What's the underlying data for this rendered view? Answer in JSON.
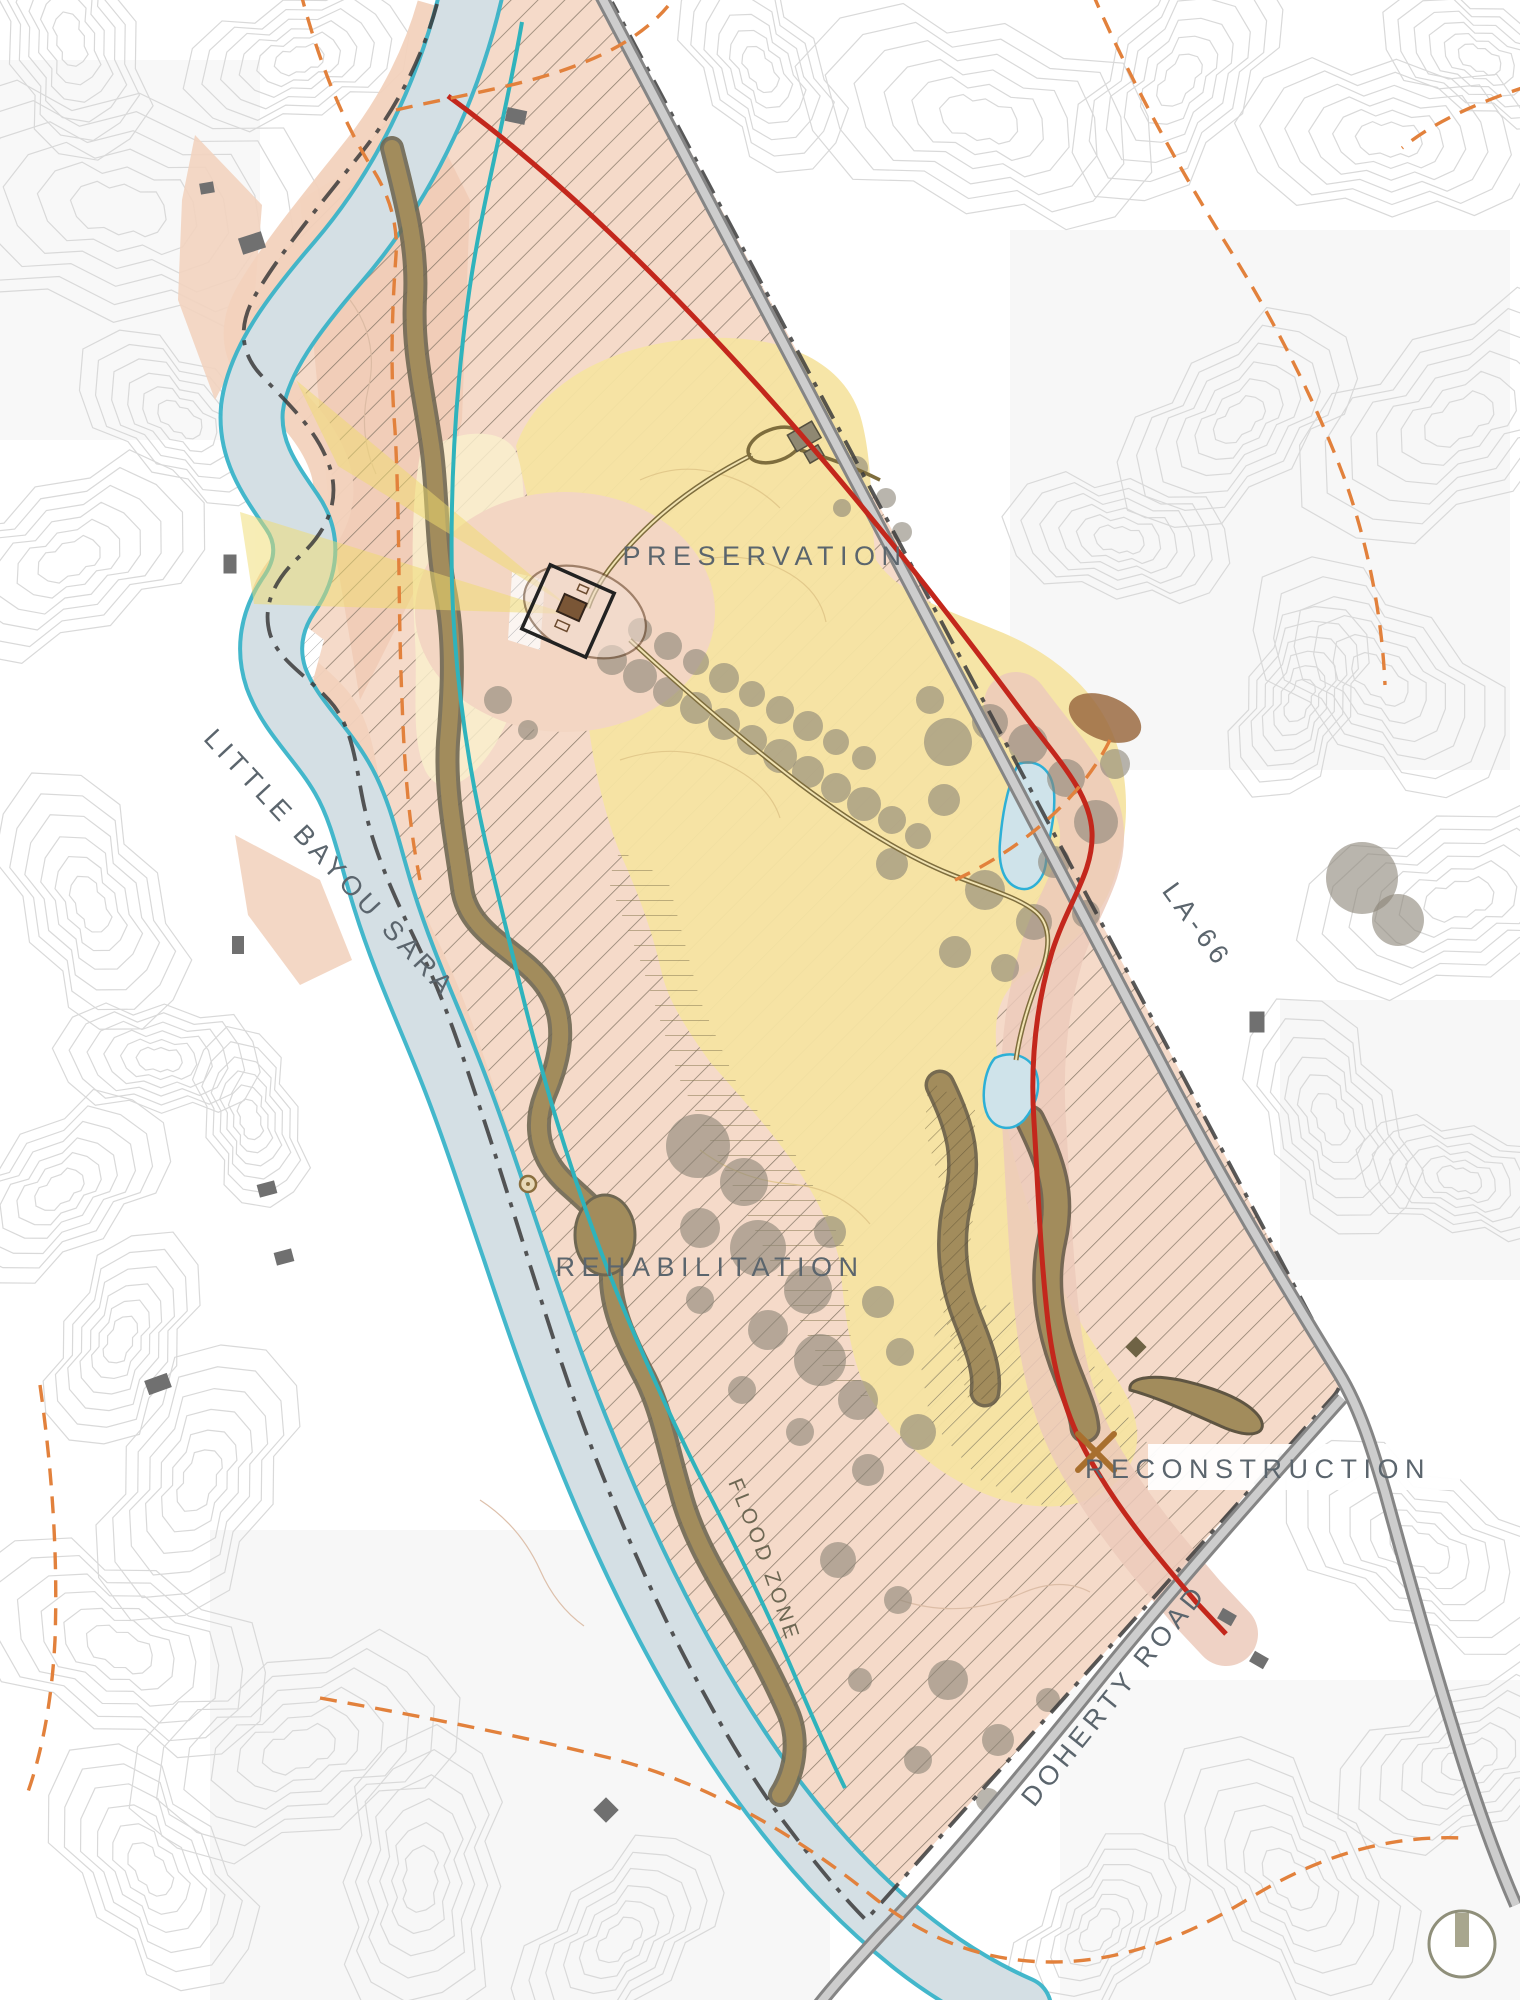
{
  "map": {
    "title": "Site Master Plan Map",
    "zones": {
      "preservation": "PRESERVATION",
      "rehabilitation": "REHABILITATION",
      "reconstruction": "RECONSTRUCTION"
    },
    "waterways": {
      "bayou": "LITTLE BAYOU SARA",
      "flood_zone": "FLOOD ZONE"
    },
    "roads": {
      "highway": "LA-66",
      "doherty": "DOHERTY ROAD"
    },
    "colors": {
      "site_fill": "#F4D8C6",
      "site_hatch": "#8B7C6C",
      "preservation_yellow": "#F5E4A2",
      "pale_yellow": "#F9EFCC",
      "viewshed_yellow": "#F0DC6E",
      "water_fill": "#D3DEE3",
      "water_edge": "#35B4C9",
      "stream_teal": "#2FB3BC",
      "route_red": "#C3271C",
      "section_line_orange": "#E2813C",
      "woodland_brown": "#A28C5C",
      "canopy_gray": "#8A8477",
      "road_gray": "#8A8A8A",
      "boundary_dark": "#3B3B3B",
      "label_gray": "#5B656D",
      "contour_gray": "#D9D9D9"
    }
  }
}
